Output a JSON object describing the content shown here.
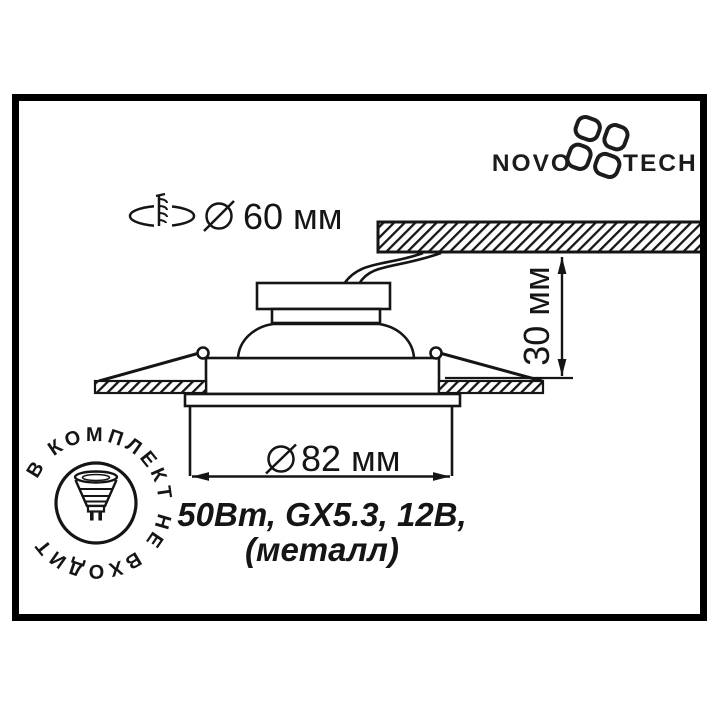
{
  "brand": {
    "logo_left": "NOVO",
    "logo_right": "TECH"
  },
  "callouts": {
    "cutout_diameter": "60 мм",
    "recess_depth": "30 мм",
    "outer_diameter": "82 мм"
  },
  "specs": {
    "line1": "50Вт, GX5.3, 12В,",
    "line2": "(металл)"
  },
  "badge": {
    "circular_text": "В КОМПЛЕКТ НЕ ВХОДИТ"
  },
  "icons": {
    "logo_mark": "petal-pinwheel-icon",
    "cutout_hole": "hole-with-screw-icon",
    "diameter_symbol": "slashed-circle-icon",
    "lamp": "mr16-lamp-icon",
    "arrows": "filled-triangle-arrowheads"
  },
  "colors": {
    "ink": "#151515",
    "frame": "#000000",
    "background": "#ffffff"
  }
}
